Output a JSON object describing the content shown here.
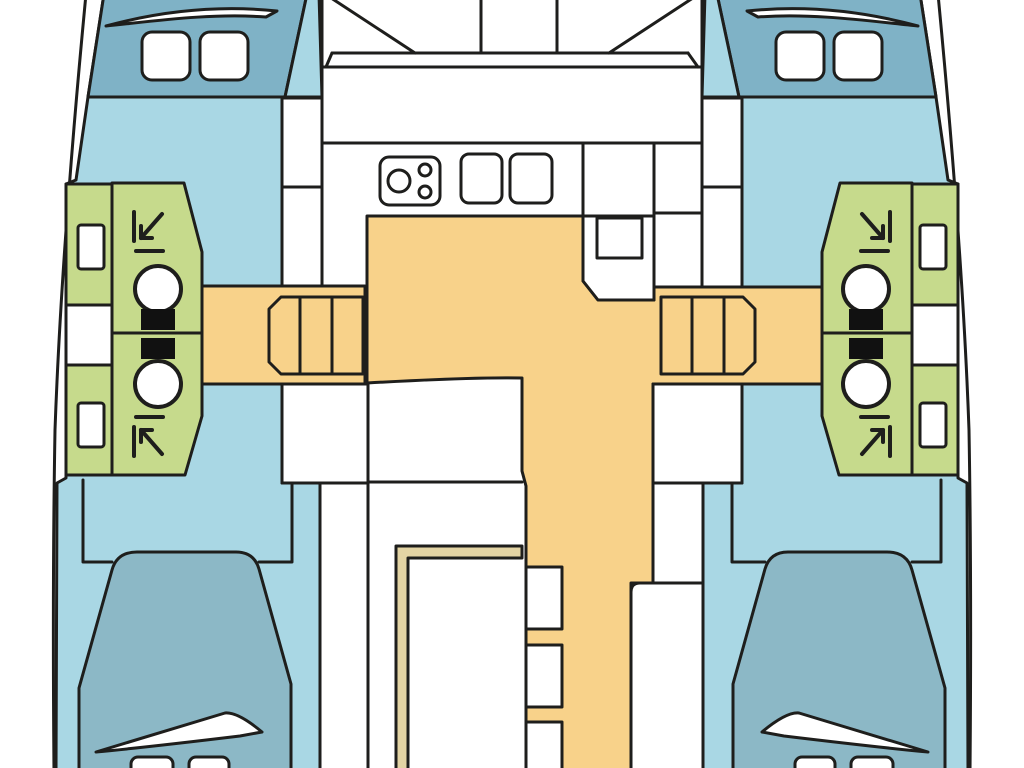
{
  "diagram": {
    "type": "boat-floorplan",
    "subject": "catamaran interior layout, top-down view",
    "orientation": "bows at top, sterns at bottom"
  },
  "colors": {
    "outline": "#1e1e1c",
    "background": "#ffffff",
    "white": "#ffffff",
    "hull_floor": "#a9d7e4",
    "bow_deck": "#7fb2c6",
    "berth": "#8cb8c6",
    "bathroom": "#c6da8c",
    "walkway": "#f8d28a",
    "trim_band": "#e3d4a4",
    "fixture_dark": "#111111"
  },
  "features": {
    "hulls": 2,
    "bow_hatches_per_hull": 2,
    "bathrooms": 4,
    "toilets": 4,
    "showers": 4,
    "washbasins": 4,
    "staircases": 2,
    "walkway_steps": 3,
    "aft_double_berths": 2,
    "pillows_per_berth": 2,
    "galley_stove_burners": 3,
    "galley_sinks": 2,
    "cockpit_bench_sections": 3
  }
}
